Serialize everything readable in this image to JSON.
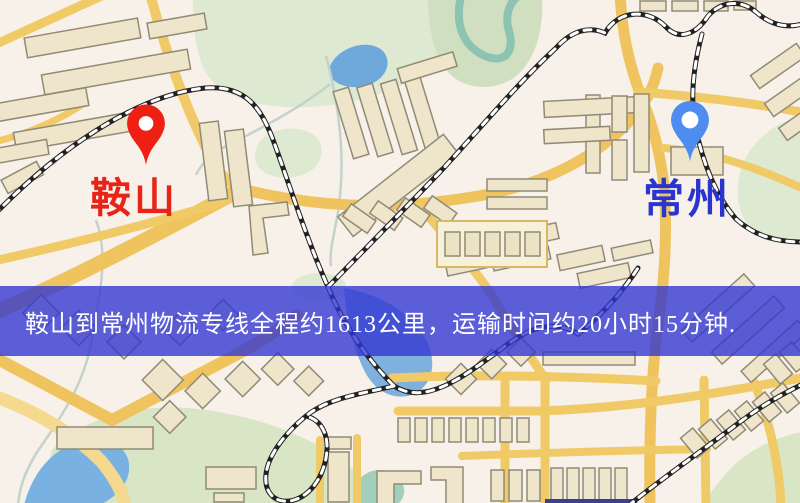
{
  "banner": {
    "text": "鞍山到常州物流专线全程约1613公里，运输时间约20小时15分钟.",
    "bg_color": "#3034d2",
    "text_color": "#ffffff"
  },
  "map": {
    "origin": {
      "name": "鞍山",
      "pin_color": "#ee2014",
      "label_color": "#e82318"
    },
    "destination": {
      "name": "常州",
      "pin_color": "#4e8def",
      "label_color": "#2a35cf"
    },
    "palette": {
      "background": "#f8f1ea",
      "road_yellow": "#f1ca68",
      "park_green": "#dde9d0",
      "water_blue": "#79b1e3",
      "railway_dark": "#222222",
      "building_beige": "#eee5ca"
    }
  }
}
